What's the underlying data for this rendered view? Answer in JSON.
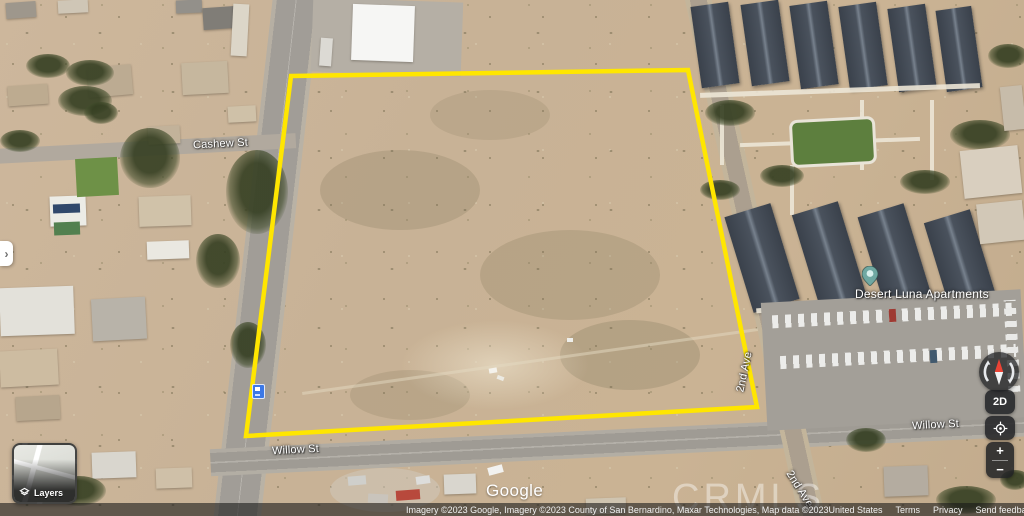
{
  "branding": {
    "logo_text": "Google"
  },
  "watermark": {
    "text": "CRMLS"
  },
  "map_labels": {
    "cashew_st": "Cashew St",
    "willow_st_left": "Willow St",
    "willow_st_right": "Willow St",
    "second_ave_upper": "2nd Ave",
    "second_ave_lower": "2nd Ave",
    "apartments": "Desert Luna Apartments"
  },
  "controls": {
    "layers_label": "Layers",
    "map_type_toggle": "2D",
    "zoom_in": "+",
    "zoom_out": "−",
    "side_panel_expand": "›"
  },
  "attribution": {
    "imagery_credit": "Imagery ©2023 Google, Imagery ©2023 County of San Bernardino, Maxar Technologies, Map data ©2023",
    "links": [
      {
        "label": "United States"
      },
      {
        "label": "Terms"
      },
      {
        "label": "Privacy"
      },
      {
        "label": "Send feedback"
      }
    ],
    "scale_label": "50 ft"
  },
  "colors": {
    "parcel_outline": "#FFE600",
    "pegman": "#FBAB18",
    "place_pin": "#6FA8A2",
    "transit_icon": "#3B78E7"
  }
}
